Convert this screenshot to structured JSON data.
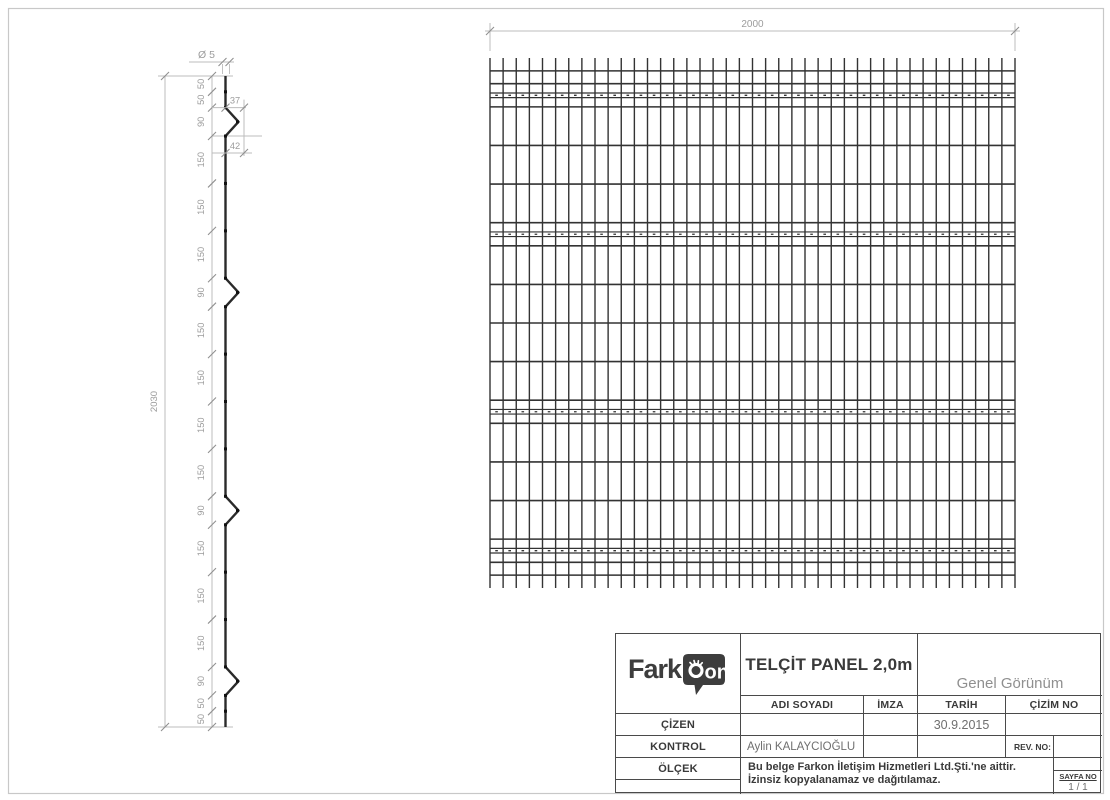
{
  "colors": {
    "wire": "#2a2a2a",
    "mesh_wire": "#333333",
    "dim_line": "#bcbcbc",
    "tick": "#8f8f8f",
    "dim_text": "#9c9c9c",
    "page_border": "#c8c8c8",
    "logo_dark": "#3d3d3d"
  },
  "drawing": {
    "profile": {
      "diameter_label": "Ø 5",
      "total_label": "2030",
      "bend_dim_top_label": "37",
      "bend_dim_bottom_label": "42",
      "segments": [
        {
          "label": "50",
          "len": 50
        },
        {
          "label": "50",
          "len": 50
        },
        {
          "label": "90",
          "len": 90,
          "bend": true
        },
        {
          "label": "150",
          "len": 150
        },
        {
          "label": "150",
          "len": 150
        },
        {
          "label": "150",
          "len": 150
        },
        {
          "label": "90",
          "len": 90,
          "bend": true
        },
        {
          "label": "150",
          "len": 150
        },
        {
          "label": "150",
          "len": 150
        },
        {
          "label": "150",
          "len": 150
        },
        {
          "label": "150",
          "len": 150
        },
        {
          "label": "90",
          "len": 90,
          "bend": true
        },
        {
          "label": "150",
          "len": 150
        },
        {
          "label": "150",
          "len": 150
        },
        {
          "label": "150",
          "len": 150
        },
        {
          "label": "90",
          "len": 90,
          "bend": true
        },
        {
          "label": "50",
          "len": 50
        },
        {
          "label": "50",
          "len": 50
        }
      ]
    },
    "panel": {
      "width_label": "2000",
      "width_mm": 2000,
      "vertical_wires": 41,
      "vertical_spacing_mm": 50
    }
  },
  "title_block": {
    "logo": {
      "word": "Fark",
      "bubble": "on"
    },
    "title": "TELÇİT PANEL 2,0m",
    "view_name": "Genel Görünüm",
    "columns": {
      "adi_soyadi": "ADI SOYADI",
      "imza": "İMZA",
      "tarih": "TARİH",
      "cizim_no": "ÇİZİM NO"
    },
    "rows": {
      "cizen_label": "ÇİZEN",
      "cizen_tarih": "30.9.2015",
      "kontrol_label": "KONTROL",
      "kontrol_adi": "Aylin KALAYCIOĞLU",
      "rev_no_label": "REV. NO:",
      "olcek_label": "ÖLÇEK"
    },
    "copyright_line1": "Bu belge Farkon İletişim Hizmetleri Ltd.Şti.'ne aittir.",
    "copyright_line2": "İzinsiz kopyalanamaz ve dağıtılamaz.",
    "sayfa_label": "SAYFA NO",
    "sayfa_value": "1 / 1"
  }
}
